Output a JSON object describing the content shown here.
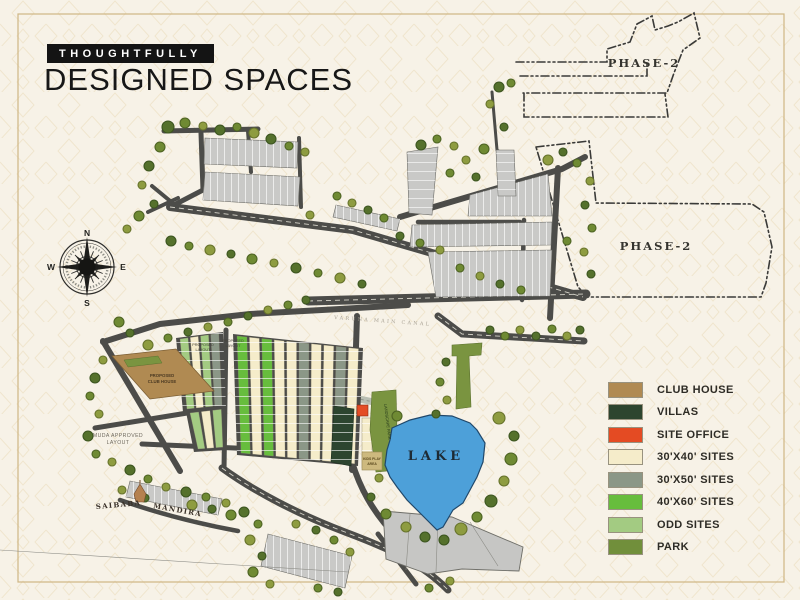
{
  "header": {
    "badge": "THOUGHTFULLY",
    "title": "DESIGNED SPACES"
  },
  "compass": {
    "north": "N",
    "east": "E",
    "south": "S",
    "west": "W"
  },
  "map": {
    "lake_color": "#4DA0D9",
    "labels": {
      "phase2_north": "PHASE-2",
      "phase2_east": "PHASE-2",
      "lake": "LAKE",
      "canal": "VARUNA MAIN CANAL",
      "temple_left": "SAIBABA",
      "temple_right": "MANDIRA",
      "muda_line1": "MUDA APPROVED",
      "muda_line2": "LAYOUT",
      "club_line1": "PROPOSED",
      "club_line2": "CLUB HOUSE",
      "proposed_line1": "PROPOSED",
      "proposed_line2": "LAYOUT",
      "landscape_park": "LANDSCAPE PARK",
      "kids_line1": "KIDS PLAY",
      "kids_line2": "AREA"
    }
  },
  "legend": {
    "items": [
      {
        "label": "CLUB HOUSE",
        "color": "#B08A52"
      },
      {
        "label": "VILLAS",
        "color": "#2D452F"
      },
      {
        "label": "SITE OFFICE",
        "color": "#E44B23"
      },
      {
        "label": "30'X40' SITES",
        "color": "#F5ECCA"
      },
      {
        "label": "30'X50' SITES",
        "color": "#8B9787"
      },
      {
        "label": "40'X60' SITES",
        "color": "#67BD3D"
      },
      {
        "label": "ODD SITES",
        "color": "#A3CB82"
      },
      {
        "label": "PARK",
        "color": "#718F3B"
      }
    ]
  }
}
